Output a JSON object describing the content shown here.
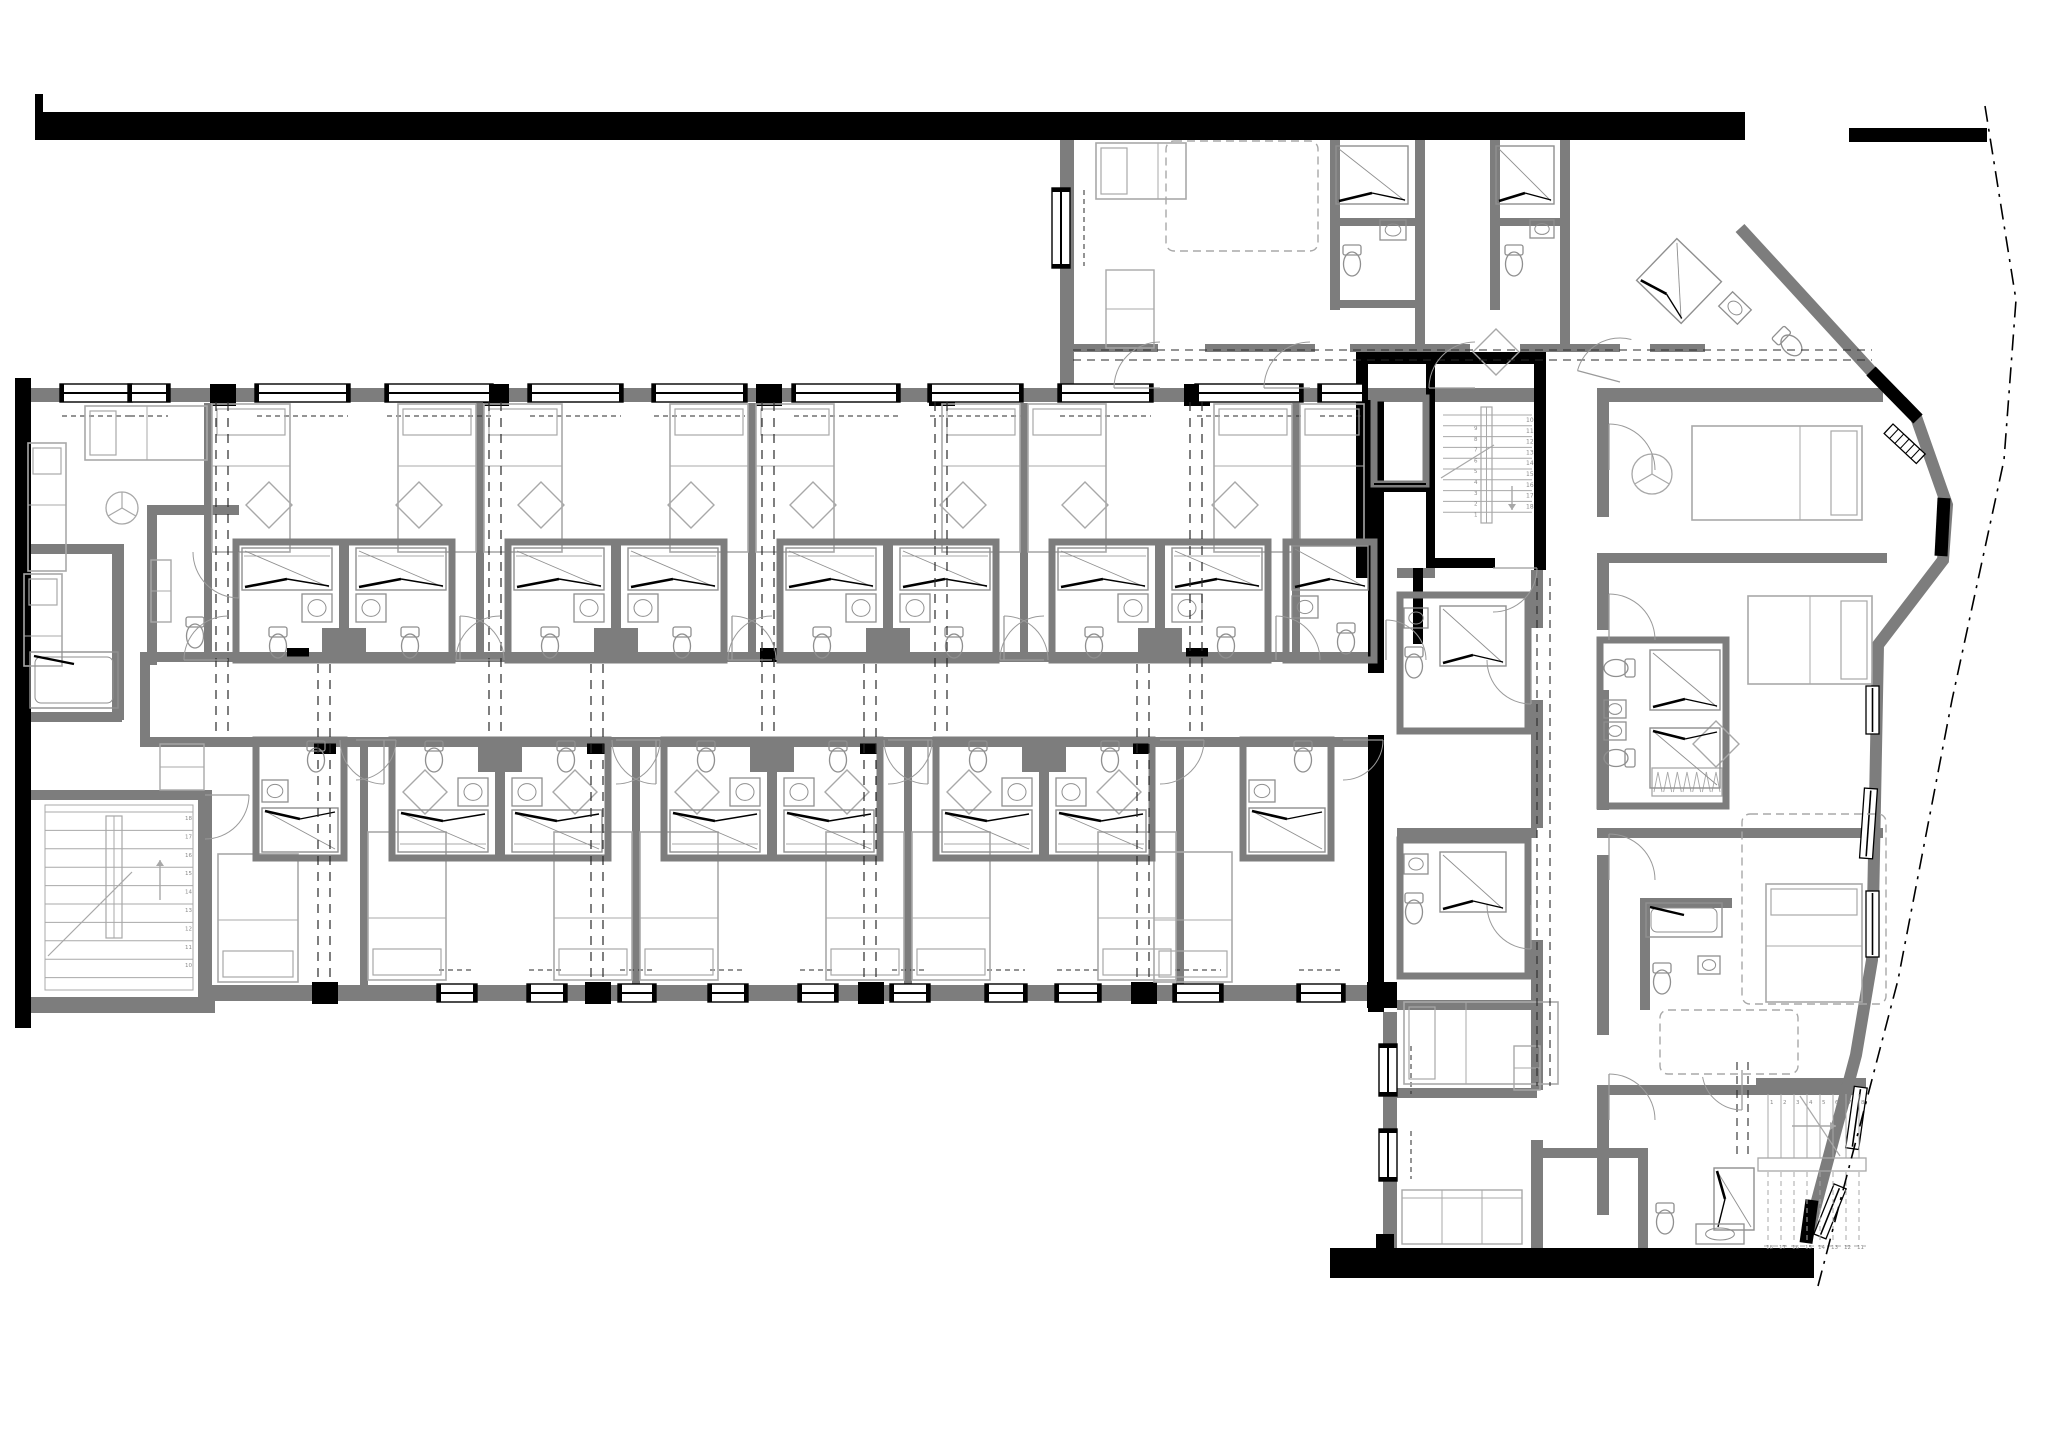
{
  "meta": {
    "title": "residential-floor-plan",
    "canvas": {
      "w": 2053,
      "h": 1453
    }
  },
  "colors": {
    "black": "#000000",
    "wall": "#7d7d7d",
    "furn": "#a8a8a8",
    "fix": "#8f8f8f",
    "dash": "#2a2a2a",
    "text": "#8a8a8a",
    "bg": "#ffffff"
  },
  "walls_black": [
    [
      35,
      94,
      8,
      20
    ],
    [
      35,
      112,
      1710,
      28
    ],
    [
      1849,
      128,
      138,
      14
    ],
    [
      15,
      378,
      16,
      650
    ],
    [
      1368,
      400,
      16,
      273
    ],
    [
      1368,
      735,
      16,
      277
    ],
    [
      1356,
      352,
      190,
      12
    ],
    [
      1356,
      352,
      12,
      226
    ],
    [
      1426,
      362,
      9,
      206
    ],
    [
      1534,
      352,
      12,
      218
    ],
    [
      1366,
      483,
      62,
      9
    ],
    [
      1433,
      558,
      62,
      10
    ],
    [
      1413,
      568,
      10,
      76
    ],
    [
      1330,
      1248,
      484,
      30
    ],
    [
      1376,
      1234,
      18,
      16
    ]
  ],
  "walls_gray": [
    [
      23,
      388,
      1520,
      14
    ],
    [
      1597,
      388,
      286,
      14
    ],
    [
      150,
      652,
      1218,
      10
    ],
    [
      150,
      737,
      1218,
      10
    ],
    [
      140,
      652,
      10,
      95
    ],
    [
      210,
      985,
      1173,
      16
    ],
    [
      15,
      997,
      200,
      16
    ],
    [
      28,
      790,
      178,
      10
    ],
    [
      198,
      790,
      14,
      207
    ],
    [
      18,
      544,
      106,
      10
    ],
    [
      112,
      552,
      12,
      168
    ],
    [
      18,
      712,
      104,
      10
    ],
    [
      147,
      505,
      92,
      10
    ],
    [
      147,
      505,
      10,
      160
    ],
    [
      1060,
      140,
      14,
      250
    ],
    [
      1330,
      140,
      10,
      170
    ],
    [
      1415,
      140,
      10,
      208
    ],
    [
      1330,
      218,
      95,
      8
    ],
    [
      1330,
      300,
      95,
      8
    ],
    [
      1490,
      140,
      10,
      170
    ],
    [
      1560,
      140,
      10,
      208
    ],
    [
      1490,
      218,
      80,
      8
    ],
    [
      1073,
      344,
      85,
      8
    ],
    [
      1205,
      344,
      110,
      8
    ],
    [
      1350,
      344,
      120,
      8
    ],
    [
      1520,
      344,
      100,
      8
    ],
    [
      1650,
      344,
      55,
      8
    ],
    [
      1597,
      553,
      290,
      10
    ],
    [
      1597,
      828,
      286,
      10
    ],
    [
      1597,
      1085,
      264,
      10
    ],
    [
      1597,
      402,
      12,
      115
    ],
    [
      1597,
      560,
      12,
      70
    ],
    [
      1597,
      690,
      12,
      120
    ],
    [
      1597,
      855,
      12,
      180
    ],
    [
      1597,
      1095,
      12,
      120
    ],
    [
      1531,
      570,
      12,
      58
    ],
    [
      1531,
      700,
      12,
      128
    ],
    [
      1531,
      940,
      12,
      150
    ],
    [
      1531,
      1140,
      12,
      108
    ],
    [
      1397,
      568,
      38,
      10
    ],
    [
      1397,
      828,
      140,
      10
    ],
    [
      1397,
      1000,
      140,
      10
    ],
    [
      1397,
      1088,
      140,
      10
    ],
    [
      1383,
      1012,
      14,
      238
    ],
    [
      1640,
      898,
      10,
      112
    ],
    [
      1640,
      898,
      92,
      10
    ],
    [
      1543,
      1148,
      100,
      10
    ],
    [
      1638,
      1148,
      10,
      102
    ],
    [
      1756,
      1078,
      110,
      12
    ]
  ],
  "columns": [
    [
      210,
      384,
      26,
      22
    ],
    [
      483,
      384,
      26,
      22
    ],
    [
      756,
      384,
      26,
      22
    ],
    [
      929,
      384,
      26,
      22
    ],
    [
      1184,
      384,
      26,
      22
    ],
    [
      312,
      982,
      26,
      22
    ],
    [
      585,
      982,
      26,
      22
    ],
    [
      858,
      982,
      26,
      22
    ],
    [
      1131,
      982,
      26,
      22
    ],
    [
      1367,
      982,
      30,
      26
    ],
    [
      287,
      648,
      22,
      14
    ],
    [
      760,
      648,
      22,
      14
    ],
    [
      1186,
      648,
      22,
      14
    ],
    [
      314,
      740,
      22,
      14
    ],
    [
      587,
      740,
      22,
      14
    ],
    [
      860,
      740,
      22,
      14
    ],
    [
      1133,
      740,
      22,
      14
    ]
  ],
  "facade": {
    "line": [
      [
        1740,
        228
      ],
      [
        1873,
        373
      ],
      [
        1916,
        417
      ],
      [
        1947,
        505
      ],
      [
        1943,
        560
      ],
      [
        1878,
        645
      ],
      [
        1872,
        960
      ],
      [
        1856,
        1055
      ],
      [
        1806,
        1242
      ]
    ],
    "width": 12,
    "blacks": [
      [
        1871,
        371,
        1918,
        419
      ],
      [
        1944,
        498,
        1941,
        556
      ],
      [
        1812,
        1200,
        1806,
        1243
      ]
    ],
    "diag_window": [
      1893,
      424,
      44,
      43
    ],
    "windows_v": [
      [
        1866,
        686,
        48,
        0
      ],
      [
        1862,
        788,
        70,
        4
      ],
      [
        1866,
        891,
        66,
        0
      ],
      [
        1850,
        1086,
        62,
        8
      ],
      [
        1824,
        1182,
        54,
        22
      ]
    ]
  },
  "property_line": [
    [
      1985,
      106
    ],
    [
      2016,
      300
    ],
    [
      2004,
      460
    ],
    [
      1952,
      700
    ],
    [
      1898,
      980
    ],
    [
      1818,
      1286
    ]
  ],
  "windows_top": [
    [
      60,
      72
    ],
    [
      128,
      42
    ],
    [
      255,
      95
    ],
    [
      385,
      108
    ],
    [
      528,
      95
    ],
    [
      652,
      95
    ],
    [
      792,
      108
    ],
    [
      928,
      95
    ],
    [
      1058,
      95
    ],
    [
      1195,
      108
    ],
    [
      1318,
      48
    ]
  ],
  "windows_bottom": [
    [
      437,
      40
    ],
    [
      527,
      40
    ],
    [
      618,
      38
    ],
    [
      708,
      40
    ],
    [
      798,
      40
    ],
    [
      890,
      40
    ],
    [
      985,
      42
    ],
    [
      1055,
      46
    ],
    [
      1173,
      50
    ],
    [
      1297,
      48
    ]
  ],
  "windows_west": [
    [
      1052,
      188,
      80
    ],
    [
      1379,
      1044,
      52
    ],
    [
      1379,
      1129,
      52
    ]
  ],
  "pods": {
    "pair_top": [
      344,
      616,
      888,
      1160
    ],
    "pair_bottom": [
      500,
      772,
      1044
    ],
    "single_top": [
      {
        "cx": 1330,
        "flip": false,
        "bed": true
      }
    ],
    "single_bottom": [
      {
        "cx": 300,
        "bed": false
      },
      {
        "cx": 1287,
        "bed": true
      }
    ]
  },
  "grid_top": {
    "xs": [
      222,
      495,
      768,
      941,
      1196
    ],
    "y1": 402,
    "y2": 736
  },
  "grid_bottom": {
    "xs": [
      324,
      597,
      870,
      1143
    ],
    "y1": 664,
    "y2": 984
  },
  "corridor_dashes": [
    {
      "o": "h",
      "p": [
        350,
        360
      ],
      "a": 1073,
      "b": 1872
    },
    {
      "o": "v",
      "p": [
        1537,
        1550
      ],
      "a": 578,
      "b": 1086
    },
    {
      "o": "v",
      "p": [
        1737,
        1748
      ],
      "a": 1062,
      "b": 1155
    }
  ],
  "stairs": {
    "main": {
      "treads": {
        "x1": 1443,
        "x2": 1532,
        "y0": 415,
        "dy": 10.8,
        "n": 10
      },
      "stringer": [
        1481,
        407,
        11,
        116
      ],
      "numsR": {
        "x": 1526,
        "y0": 422,
        "dy": 10.8,
        "v": [
          "10",
          "11",
          "12",
          "13",
          "14",
          "15",
          "16",
          "17",
          "18"
        ]
      },
      "numsL": {
        "x": 1474,
        "y0": 430,
        "dy": 10.8,
        "v": [
          "9",
          "8",
          "7",
          "6",
          "5",
          "4",
          "3",
          "2",
          "1"
        ]
      },
      "brk": [
        1441,
        478,
        1494,
        445
      ],
      "arrow": [
        1512,
        486,
        1512,
        510
      ]
    },
    "sw": {
      "treads": {
        "x1": 45,
        "x2": 193,
        "y0": 812,
        "dy": 18.4,
        "n": 10
      },
      "stringer": [
        106,
        816,
        16,
        122
      ],
      "numsR": {
        "x": 185,
        "y0": 820,
        "dy": 18.4,
        "v": [
          "18",
          "17",
          "16",
          "15",
          "14",
          "13",
          "12",
          "11",
          "10"
        ]
      },
      "brk": [
        48,
        956,
        132,
        872
      ],
      "arrow": [
        160,
        900,
        160,
        860
      ]
    },
    "se": {
      "top": {
        "x0": 1768,
        "dx": 13,
        "n": 8,
        "y1": 1094,
        "y2": 1158
      },
      "numsT": {
        "y": 1104,
        "x0": 1770,
        "dx": 13,
        "v": [
          "1",
          "2",
          "3",
          "4",
          "5",
          "6",
          "7",
          "8"
        ]
      },
      "bar": [
        1758,
        1158,
        108,
        13
      ],
      "bottom": {
        "x0": 1768,
        "dx": 13,
        "n": 8,
        "y1": 1172,
        "y2": 1242
      },
      "numsB": {
        "y": 1249,
        "x0": 1766,
        "dx": 13,
        "v": [
          "18",
          "17",
          "16",
          "15",
          "14",
          "13",
          "12",
          "11"
        ]
      },
      "diag": [
        1800,
        1096,
        1840,
        1156
      ],
      "arrow": [
        1792,
        1126,
        1836,
        1126
      ]
    }
  },
  "misc": [
    {
      "t": "bedh",
      "x": 85,
      "y": 406,
      "w": 122,
      "h": 54,
      "p": "l"
    },
    {
      "t": "bedv",
      "x": 28,
      "y": 443,
      "w": 38,
      "h": 128,
      "p": "t"
    },
    {
      "t": "fan",
      "x": 122,
      "y": 508,
      "r": 16
    },
    {
      "t": "tub",
      "x": 30,
      "y": 652,
      "w": 88,
      "h": 56
    },
    {
      "t": "ward",
      "x": 151,
      "y": 560,
      "w": 20,
      "h": 62
    },
    {
      "t": "toilet",
      "x": 195,
      "y": 634,
      "r": 0
    },
    {
      "t": "arc",
      "x": 239,
      "y": 552,
      "r": 46,
      "a0": 90,
      "a1": 180
    },
    {
      "t": "bedh",
      "x": 1096,
      "y": 143,
      "w": 90,
      "h": 56,
      "p": "l"
    },
    {
      "t": "bedd",
      "x": 1166,
      "y": 141,
      "w": 152,
      "h": 110
    },
    {
      "t": "ward",
      "x": 1106,
      "y": 270,
      "w": 48,
      "h": 78
    },
    {
      "t": "shower",
      "x": 1336,
      "y": 146,
      "w": 72,
      "h": 58,
      "d": "b"
    },
    {
      "t": "toilet",
      "x": 1352,
      "y": 262,
      "r": 0
    },
    {
      "t": "sink",
      "x": 1380,
      "y": 220,
      "w": 26,
      "h": 20
    },
    {
      "t": "shower",
      "x": 1496,
      "y": 146,
      "w": 58,
      "h": 58,
      "d": "b"
    },
    {
      "t": "toilet",
      "x": 1514,
      "y": 262,
      "r": 0
    },
    {
      "t": "sink",
      "x": 1530,
      "y": 220,
      "w": 24,
      "h": 18
    },
    {
      "t": "dia",
      "x": 1496,
      "y": 352,
      "s": 46
    },
    {
      "t": "shower",
      "x": 1648,
      "y": 252,
      "w": 62,
      "h": 58,
      "d": "b",
      "rot": 44,
      "rx": 1679,
      "ry": 281
    },
    {
      "t": "sink",
      "x": 1722,
      "y": 298,
      "w": 26,
      "h": 20,
      "rot": 44,
      "rx": 1735,
      "ry": 308
    },
    {
      "t": "toilet",
      "x": 1790,
      "y": 344,
      "r": -46
    },
    {
      "t": "bedh",
      "x": 1692,
      "y": 426,
      "w": 170,
      "h": 94,
      "p": "r"
    },
    {
      "t": "fan",
      "x": 1652,
      "y": 474,
      "r": 20
    },
    {
      "t": "box",
      "x": 1600,
      "y": 640,
      "w": 126,
      "h": 166
    },
    {
      "t": "shower",
      "x": 1650,
      "y": 650,
      "w": 70,
      "h": 60,
      "d": "b"
    },
    {
      "t": "shower",
      "x": 1650,
      "y": 728,
      "w": 70,
      "h": 60,
      "d": "t"
    },
    {
      "t": "toilet",
      "x": 1618,
      "y": 668,
      "r": 90
    },
    {
      "t": "toilet",
      "x": 1618,
      "y": 758,
      "r": 90
    },
    {
      "t": "sink",
      "x": 1604,
      "y": 700,
      "w": 22,
      "h": 18
    },
    {
      "t": "sink",
      "x": 1604,
      "y": 722,
      "w": 22,
      "h": 18
    },
    {
      "t": "bedh",
      "x": 1748,
      "y": 596,
      "w": 124,
      "h": 88,
      "p": "r"
    },
    {
      "t": "dia",
      "x": 1716,
      "y": 744,
      "s": 46
    },
    {
      "t": "hang",
      "x": 1652,
      "y": 768,
      "w": 70,
      "h": 28
    },
    {
      "t": "bedv",
      "x": 1766,
      "y": 884,
      "w": 96,
      "h": 118,
      "p": "t"
    },
    {
      "t": "bedd",
      "x": 1742,
      "y": 814,
      "w": 144,
      "h": 190
    },
    {
      "t": "toilet",
      "x": 1662,
      "y": 980,
      "r": 0
    },
    {
      "t": "tub",
      "x": 1646,
      "y": 903,
      "w": 76,
      "h": 34
    },
    {
      "t": "sink",
      "x": 1698,
      "y": 956,
      "w": 22,
      "h": 18
    },
    {
      "t": "bedd",
      "x": 1660,
      "y": 1010,
      "w": 138,
      "h": 64
    },
    {
      "t": "toilet",
      "x": 1665,
      "y": 1220,
      "r": 0
    },
    {
      "t": "shower",
      "x": 1714,
      "y": 1168,
      "w": 40,
      "h": 62,
      "d": "l"
    },
    {
      "t": "sink",
      "x": 1696,
      "y": 1224,
      "w": 48,
      "h": 20
    },
    {
      "t": "box",
      "x": 1400,
      "y": 595,
      "w": 128,
      "h": 136
    },
    {
      "t": "shower",
      "x": 1440,
      "y": 606,
      "w": 66,
      "h": 60,
      "d": "b"
    },
    {
      "t": "toilet",
      "x": 1414,
      "y": 664,
      "r": 0
    },
    {
      "t": "sink",
      "x": 1404,
      "y": 608,
      "w": 24,
      "h": 20
    },
    {
      "t": "box",
      "x": 1400,
      "y": 840,
      "w": 128,
      "h": 136
    },
    {
      "t": "shower",
      "x": 1440,
      "y": 852,
      "w": 66,
      "h": 60,
      "d": "b"
    },
    {
      "t": "toilet",
      "x": 1414,
      "y": 910,
      "r": 0
    },
    {
      "t": "sink",
      "x": 1404,
      "y": 854,
      "w": 24,
      "h": 20
    },
    {
      "t": "bedh",
      "x": 1404,
      "y": 1002,
      "w": 154,
      "h": 82,
      "p": "l"
    },
    {
      "t": "ward",
      "x": 1514,
      "y": 1046,
      "w": 26,
      "h": 44
    },
    {
      "t": "couch",
      "x": 1402,
      "y": 1190,
      "w": 120,
      "h": 54
    },
    {
      "t": "ward",
      "x": 160,
      "y": 744,
      "w": 44,
      "h": 46
    },
    {
      "t": "bedv",
      "x": 218,
      "y": 854,
      "w": 80,
      "h": 128,
      "p": "b"
    },
    {
      "t": "bedv",
      "x": 24,
      "y": 574,
      "w": 38,
      "h": 92,
      "p": "t"
    },
    {
      "t": "box",
      "x": 1374,
      "y": 398,
      "w": 52,
      "h": 86
    },
    {
      "t": "ln",
      "x1": 1374,
      "y1": 484,
      "x2": 1426,
      "y2": 484
    },
    {
      "t": "arc",
      "x": 1160,
      "y": 388,
      "r": 46,
      "a0": 180,
      "a1": 270
    },
    {
      "t": "arc",
      "x": 1310,
      "y": 388,
      "r": 46,
      "a0": 180,
      "a1": 270
    },
    {
      "t": "arc",
      "x": 1475,
      "y": 388,
      "r": 46,
      "a0": 180,
      "a1": 270
    },
    {
      "t": "arc",
      "x": 1620,
      "y": 382,
      "r": 44,
      "a0": 195,
      "a1": 285
    },
    {
      "t": "arc",
      "x": 1609,
      "y": 470,
      "r": 46,
      "a0": 270,
      "a1": 360
    },
    {
      "t": "arc",
      "x": 1609,
      "y": 640,
      "r": 46,
      "a0": 270,
      "a1": 360
    },
    {
      "t": "arc",
      "x": 1609,
      "y": 880,
      "r": 46,
      "a0": 270,
      "a1": 360
    },
    {
      "t": "arc",
      "x": 1609,
      "y": 1120,
      "r": 46,
      "a0": 270,
      "a1": 360
    },
    {
      "t": "arc",
      "x": 1531,
      "y": 660,
      "r": 44,
      "a0": 90,
      "a1": 180
    },
    {
      "t": "arc",
      "x": 1531,
      "y": 905,
      "r": 44,
      "a0": 90,
      "a1": 180
    },
    {
      "t": "arc",
      "x": 1493,
      "y": 568,
      "r": 44,
      "a0": 0,
      "a1": 90
    },
    {
      "t": "arc",
      "x": 205,
      "y": 795,
      "r": 44,
      "a0": 0,
      "a1": 90
    },
    {
      "t": "arc",
      "x": 1742,
      "y": 1070,
      "r": 40,
      "a0": 90,
      "a1": 170
    }
  ]
}
